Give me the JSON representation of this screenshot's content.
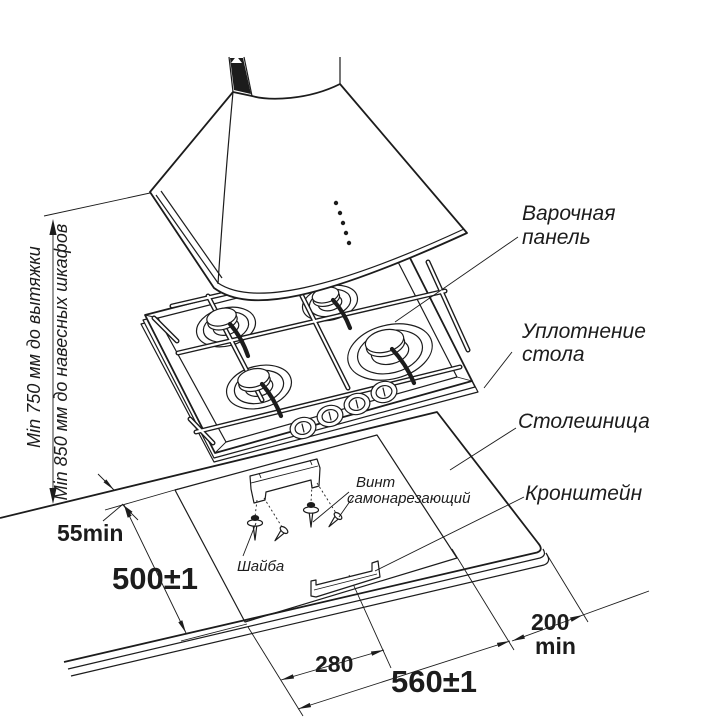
{
  "labels": {
    "hob": {
      "line1": "Варочная",
      "line2": "панель"
    },
    "seal": {
      "line1": "Уплотнение",
      "line2": "стола"
    },
    "countertop": "Столешница",
    "bracket": "Кронштейн",
    "screw": {
      "line1": "Винт",
      "line2": "самонарезающий"
    },
    "washer": "Шайба"
  },
  "dimensions": {
    "hood_clearance": "Min 750 мм до вытяжки",
    "cabinet_clearance": "Min 850 мм до навесных шкафов",
    "edge_to_cutout": "55min",
    "cutout_depth": "500±1",
    "bracket_offset": "280",
    "cutout_width": "560±1",
    "side_clearance_value": "200",
    "side_clearance_unit": "min"
  },
  "colors": {
    "line": "#1c1c1c",
    "background": "#ffffff"
  }
}
